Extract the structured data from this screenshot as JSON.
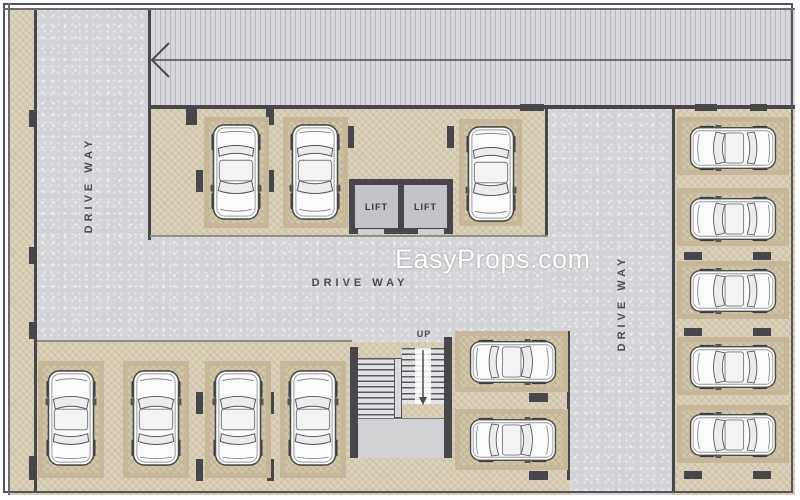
{
  "plan": {
    "watermark": "EasyProps.com",
    "labels": {
      "driveway_left": "DRIVE WAY",
      "driveway_center": "DRIVE WAY",
      "driveway_right": "DRIVE WAY",
      "lift_left": "LIFT",
      "lift_right": "LIFT",
      "stairs_up": "UP"
    },
    "colors": {
      "parking_beige": "#dcd2bc",
      "stall_beige": "#d2c6aa",
      "driveway_gray": "#d4d4d8",
      "ramp_gray": "#d8d8dc",
      "wall_dark": "#46464b",
      "label_gray": "#4c4c50",
      "watermark_white": "#ffffff"
    },
    "inventory": {
      "cars_top_row": 3,
      "cars_bottom_left_row": 4,
      "cars_beside_stairs": 2,
      "cars_right_column": 5,
      "lifts": 2,
      "staircases": 1,
      "ramp_arrow_direction": "left"
    }
  }
}
